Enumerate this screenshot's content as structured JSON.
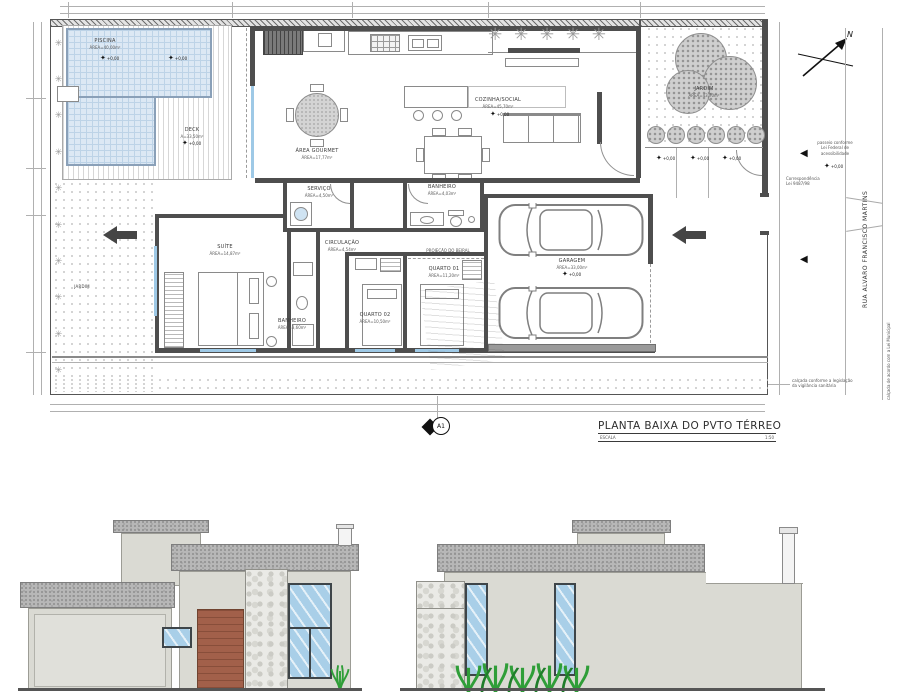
{
  "plan": {
    "title": "PLANTA BAIXA DO PVTO TÉRREO",
    "scale_label": "ESCALA",
    "scale_value": "1:50",
    "north_label": "N",
    "section_marker_label": "A1",
    "street_name": "RUA ALVARO FRANCISCO MARTINS",
    "level_label": "+0,00",
    "icons": {
      "plant_glyph": "✳",
      "level_glyph": "✦",
      "slope_glyph": "◀"
    },
    "rooms": {
      "piscina": {
        "name": "PISCINA",
        "area": "ÁREA=40,00m²"
      },
      "deck": {
        "name": "DECK",
        "area": "A=33,50m²"
      },
      "area_gourmet": {
        "name": "ÁREA GOURMET",
        "area": "ÁREA=17,77m²"
      },
      "servico": {
        "name": "SERVIÇO",
        "area": "ÁREA=4,50m²"
      },
      "cozinha_social": {
        "name": "COZINHA/SOCIAL",
        "area": "ÁREA=45,70m²"
      },
      "banheiro_social": {
        "name": "BANHEIRO",
        "area": "ÁREA=4,03m²"
      },
      "jardim": {
        "name": "JARDIM",
        "area": "ÁREA=43,70m²"
      },
      "jardim_lateral": {
        "name": "JARDIM"
      },
      "suite": {
        "name": "SUÍTE",
        "area": "ÁREA=14,87m²"
      },
      "banheiro_suite": {
        "name": "BANHEIRO",
        "area": "ÁREA=3,60m²"
      },
      "circulacao": {
        "name": "CIRCULAÇÃO",
        "area": "ÁREA=4,54m²"
      },
      "quarto02": {
        "name": "QUARTO 02",
        "area": "ÁREA=10,50m²"
      },
      "quarto01": {
        "name": "QUARTO 01",
        "area": "ÁREA=11,20m²"
      },
      "garagem": {
        "name": "GARAGEM",
        "area": "ÁREA=33,00m²"
      }
    },
    "annotations": {
      "projecao": "PROJEÇÃO DO BEIRAL",
      "acess_1": "passeio conforme",
      "acess_2": "Lei Federal de",
      "acess_3": "acessibilidade",
      "corresp_1": "Correspondência",
      "corresp_2": "Lei 9487/98",
      "sanit_1": "calçada conforme a legislação",
      "sanit_2": "da vigilância sanitária",
      "sidewalk_note": "calçada de acordo com a Lei Municipal"
    }
  }
}
